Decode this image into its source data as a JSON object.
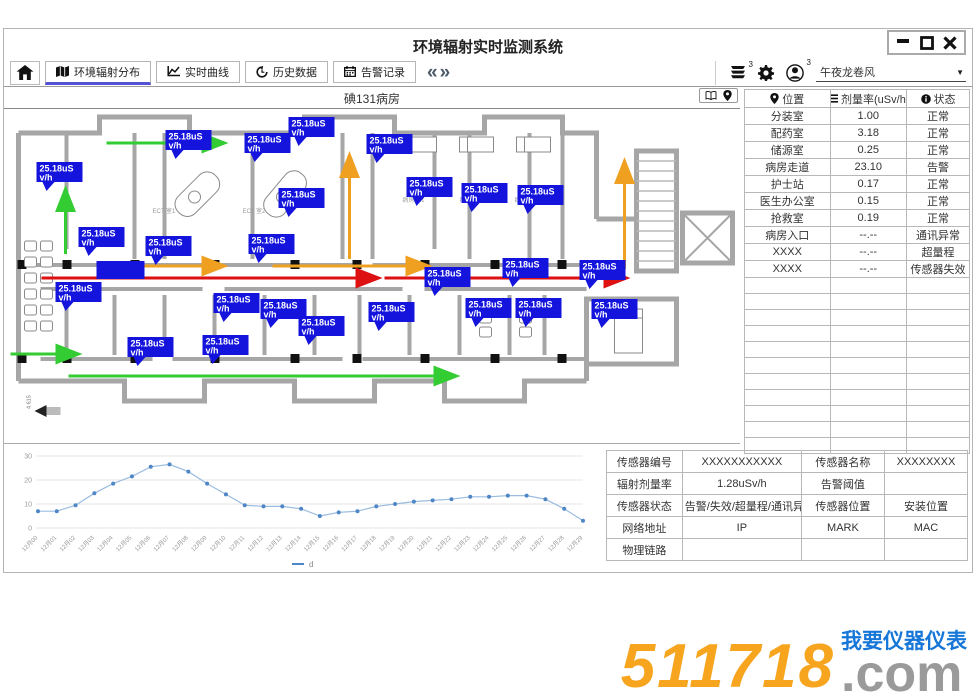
{
  "app": {
    "title": "环境辐射实时监测系统"
  },
  "icons": [
    "minimize-icon",
    "maximize-icon",
    "close-icon",
    "home-icon",
    "map-icon",
    "curve-icon",
    "history-icon",
    "calendar-icon",
    "chevron-double-left-icon",
    "chevron-double-right-icon",
    "messages-icon",
    "gear-icon",
    "user-icon",
    "dropdown-arrow-icon",
    "book-icon",
    "pin-icon",
    "list-icon",
    "info-icon"
  ],
  "toolbar": {
    "tabs": [
      {
        "key": "distribution",
        "label": "环境辐射分布",
        "icon": "map-icon",
        "active": true
      },
      {
        "key": "realtime",
        "label": "实时曲线",
        "icon": "curve-icon",
        "active": false
      },
      {
        "key": "history",
        "label": "历史数据",
        "icon": "history-icon",
        "active": false
      },
      {
        "key": "alarms",
        "label": "告警记录",
        "icon": "calendar-icon",
        "active": false
      }
    ],
    "nav_back": "«",
    "nav_forward": "»",
    "badge_messages": "3",
    "badge_user": "3",
    "user_name": "午夜龙卷风",
    "dropdown_arrow": "▼"
  },
  "floorplan": {
    "title": "碘131病房",
    "sensor_tag": {
      "line1": "25.18uS",
      "line2": "v/h"
    },
    "tag_color": "#1414dc",
    "tags": [
      [
        32,
        53
      ],
      [
        74,
        118
      ],
      [
        141,
        127
      ],
      [
        244,
        125
      ],
      [
        161,
        21
      ],
      [
        240,
        24
      ],
      [
        284,
        8
      ],
      [
        274,
        79
      ],
      [
        362,
        25
      ],
      [
        402,
        68
      ],
      [
        457,
        74
      ],
      [
        513,
        76
      ],
      [
        498,
        149
      ],
      [
        575,
        151
      ],
      [
        420,
        158
      ],
      [
        51,
        173
      ],
      [
        209,
        184
      ],
      [
        256,
        190
      ],
      [
        294,
        207
      ],
      [
        198,
        226
      ],
      [
        123,
        228
      ],
      [
        364,
        193
      ],
      [
        461,
        189
      ],
      [
        511,
        189
      ],
      [
        587,
        190
      ]
    ],
    "solid_box": [
      92,
      152
    ],
    "room_labels": [
      {
        "text": "ECT 室1",
        "x": 148,
        "y": 104
      },
      {
        "text": "ECT 室2",
        "x": 238,
        "y": 104
      },
      {
        "text": "病房001",
        "x": 398,
        "y": 93
      },
      {
        "text": "病房002",
        "x": 455,
        "y": 93
      },
      {
        "text": "病房003",
        "x": 510,
        "y": 93
      }
    ],
    "dimension": "4.615"
  },
  "status_table": {
    "headers": [
      {
        "icon": "pin-icon",
        "label": "位置"
      },
      {
        "icon": "list-icon",
        "label": "剂量率(uSv/h)"
      },
      {
        "icon": "info-icon",
        "label": "状态"
      }
    ],
    "col_widths": [
      "38%",
      "34%",
      "28%"
    ],
    "rows": [
      {
        "location": "分装室",
        "dose": "1.00",
        "status": "正常"
      },
      {
        "location": "配药室",
        "dose": "3.18",
        "status": "正常"
      },
      {
        "location": "储源室",
        "dose": "0.25",
        "status": "正常"
      },
      {
        "location": "病房走道",
        "dose": "23.10",
        "status": "告警"
      },
      {
        "location": "护士站",
        "dose": "0.17",
        "status": "正常"
      },
      {
        "location": "医生办公室",
        "dose": "0.15",
        "status": "正常"
      },
      {
        "location": "抢救室",
        "dose": "0.19",
        "status": "正常"
      },
      {
        "location": "病房入口",
        "dose": "--.--",
        "status": "通讯异常"
      },
      {
        "location": "XXXX",
        "dose": "--.--",
        "status": "超量程"
      },
      {
        "location": "XXXX",
        "dose": "--.--",
        "status": "传感器失效"
      }
    ],
    "empty_row_count": 11
  },
  "chart_data": {
    "type": "line",
    "title": "",
    "xlabel": "",
    "ylabel": "",
    "ylim": [
      0,
      30
    ],
    "yticks": [
      0,
      10,
      20,
      30
    ],
    "grid": true,
    "legend": "d",
    "legend_position": "bottom",
    "x": [
      "12月00",
      "12月01",
      "12月02",
      "12月03",
      "12月04",
      "12月05",
      "12月06",
      "12月07",
      "12月08",
      "12月09",
      "12月10",
      "12月11",
      "12月12",
      "12月13",
      "12月14",
      "12月15",
      "12月16",
      "12月17",
      "12月18",
      "12月19",
      "12月20",
      "12月21",
      "12月22",
      "12月23",
      "12月24",
      "12月25",
      "12月26",
      "12月27",
      "12月28",
      "12月29"
    ],
    "values": [
      7,
      7,
      9.5,
      14.5,
      18.5,
      21.5,
      25.5,
      26.5,
      23.5,
      18.5,
      14,
      9.5,
      9,
      9,
      8,
      5,
      6.5,
      7,
      9,
      10,
      11,
      11.5,
      12,
      13,
      13,
      13.5,
      13.5,
      12,
      8,
      3
    ]
  },
  "sensor_table": {
    "col_widths": [
      "21%",
      "33%",
      "23%",
      "23%"
    ],
    "rows": [
      [
        "传感器编号",
        "XXXXXXXXXXX",
        "传感器名称",
        "XXXXXXXX"
      ],
      [
        "辐射剂量率",
        "1.28uSv/h",
        "告警阈值",
        ""
      ],
      [
        "传感器状态",
        "告警/失效/超量程/通讯异常",
        "传感器位置",
        "安装位置"
      ],
      [
        "网络地址",
        "IP",
        "MARK",
        "MAC"
      ],
      [
        "物理链路",
        "",
        "",
        ""
      ]
    ]
  },
  "logo": {
    "number": "511718",
    "suffix": ".com",
    "tagline": "我要仪器仪表"
  }
}
